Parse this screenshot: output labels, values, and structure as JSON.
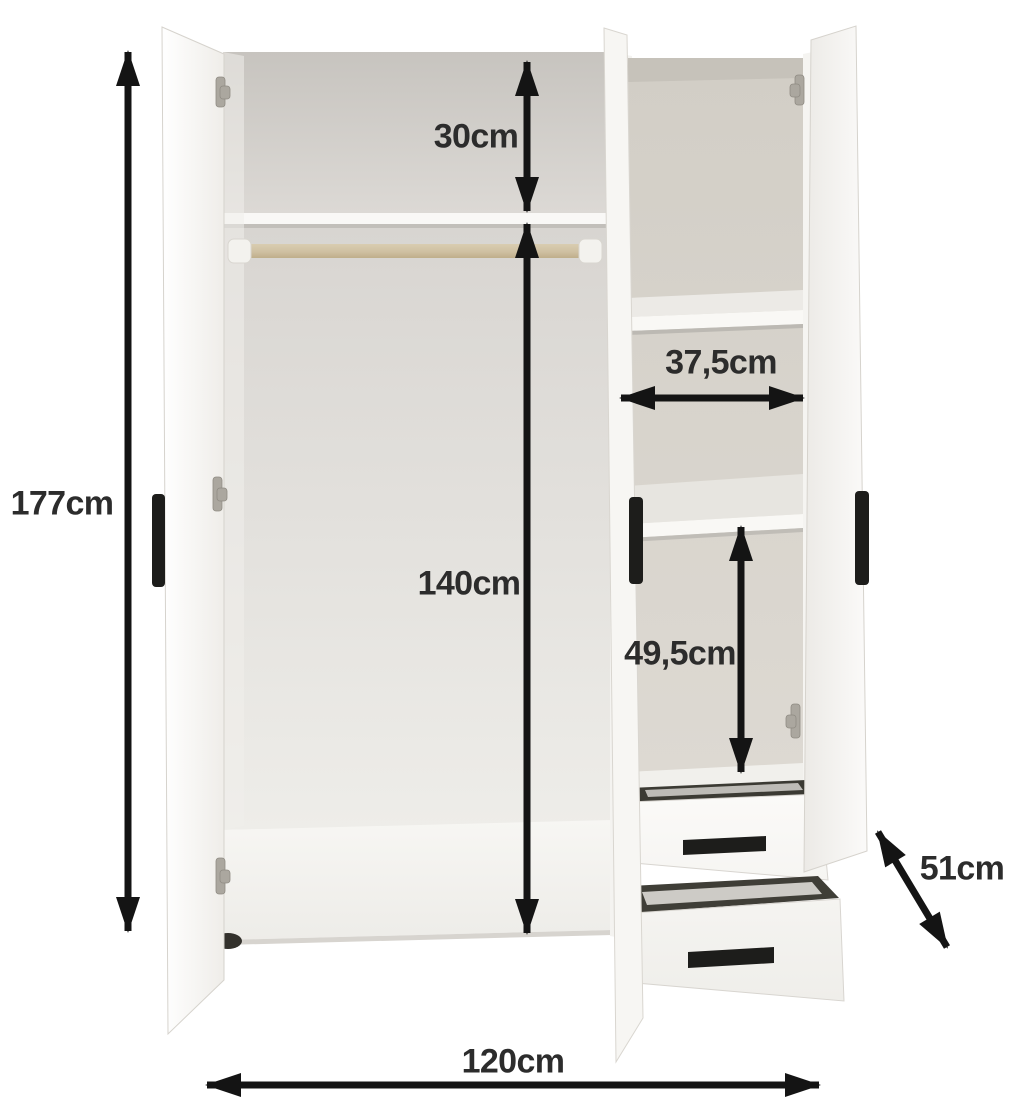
{
  "diagram": {
    "dimensions": {
      "height": "177cm",
      "top_shelf_height": "30cm",
      "hanging_height": "140cm",
      "shelf_width": "37,5cm",
      "lower_shelf_height": "49,5cm",
      "depth": "51cm",
      "width": "120cm"
    },
    "colors": {
      "background": "#ffffff",
      "arrow": "#141414",
      "label_text": "#2c2c2c",
      "cabinet_white": "#f9f8f5",
      "interior_gray": "#d8d4cd",
      "rail_tan": "#cfc0a2",
      "handle_black": "#1d1d1b"
    }
  }
}
